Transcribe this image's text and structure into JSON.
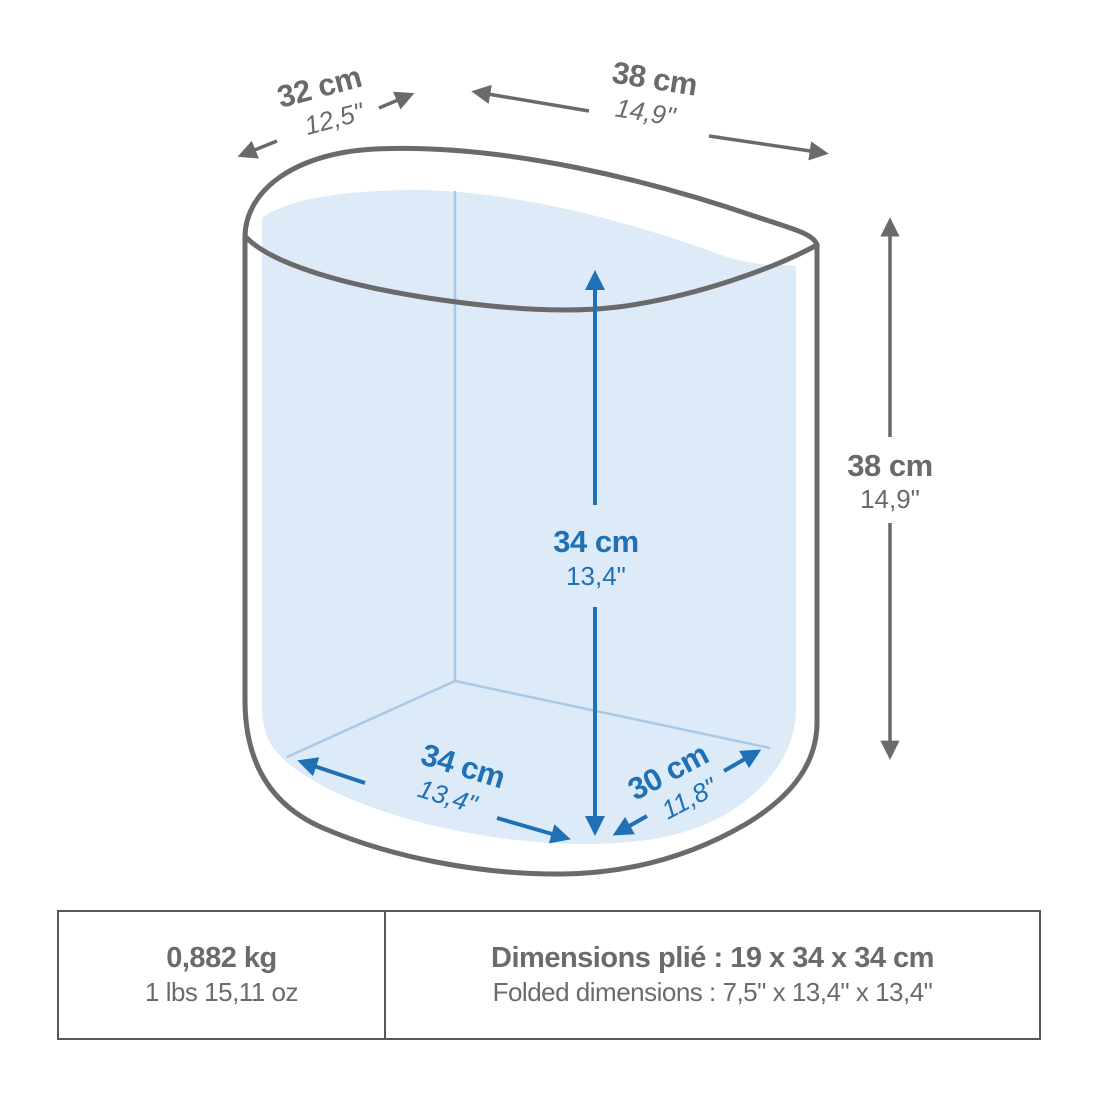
{
  "colors": {
    "outline_gray": "#6a6a6a",
    "text_gray": "#6b6b6b",
    "accent_blue": "#2070b5",
    "interior_fill": "#dcebf7",
    "interior_edge": "#a9c9e6",
    "table_border": "#58585a"
  },
  "labels": {
    "top_depth": {
      "cm": "32 cm",
      "inch": "12,5\""
    },
    "top_width": {
      "cm": "38 cm",
      "inch": "14,9\""
    },
    "outer_height": {
      "cm": "38 cm",
      "inch": "14,9\""
    },
    "inner_height": {
      "cm": "34 cm",
      "inch": "13,4\""
    },
    "bottom_width": {
      "cm": "34 cm",
      "inch": "13,4\""
    },
    "bottom_depth": {
      "cm": "30 cm",
      "inch": "11,8\""
    }
  },
  "table": {
    "weight_metric": "0,882 kg",
    "weight_imperial": "1 lbs 15,11 oz",
    "folded_metric": "Dimensions plié : 19 x 34 x 34 cm",
    "folded_imperial": "Folded dimensions : 7,5\" x 13,4\" x 13,4\""
  }
}
